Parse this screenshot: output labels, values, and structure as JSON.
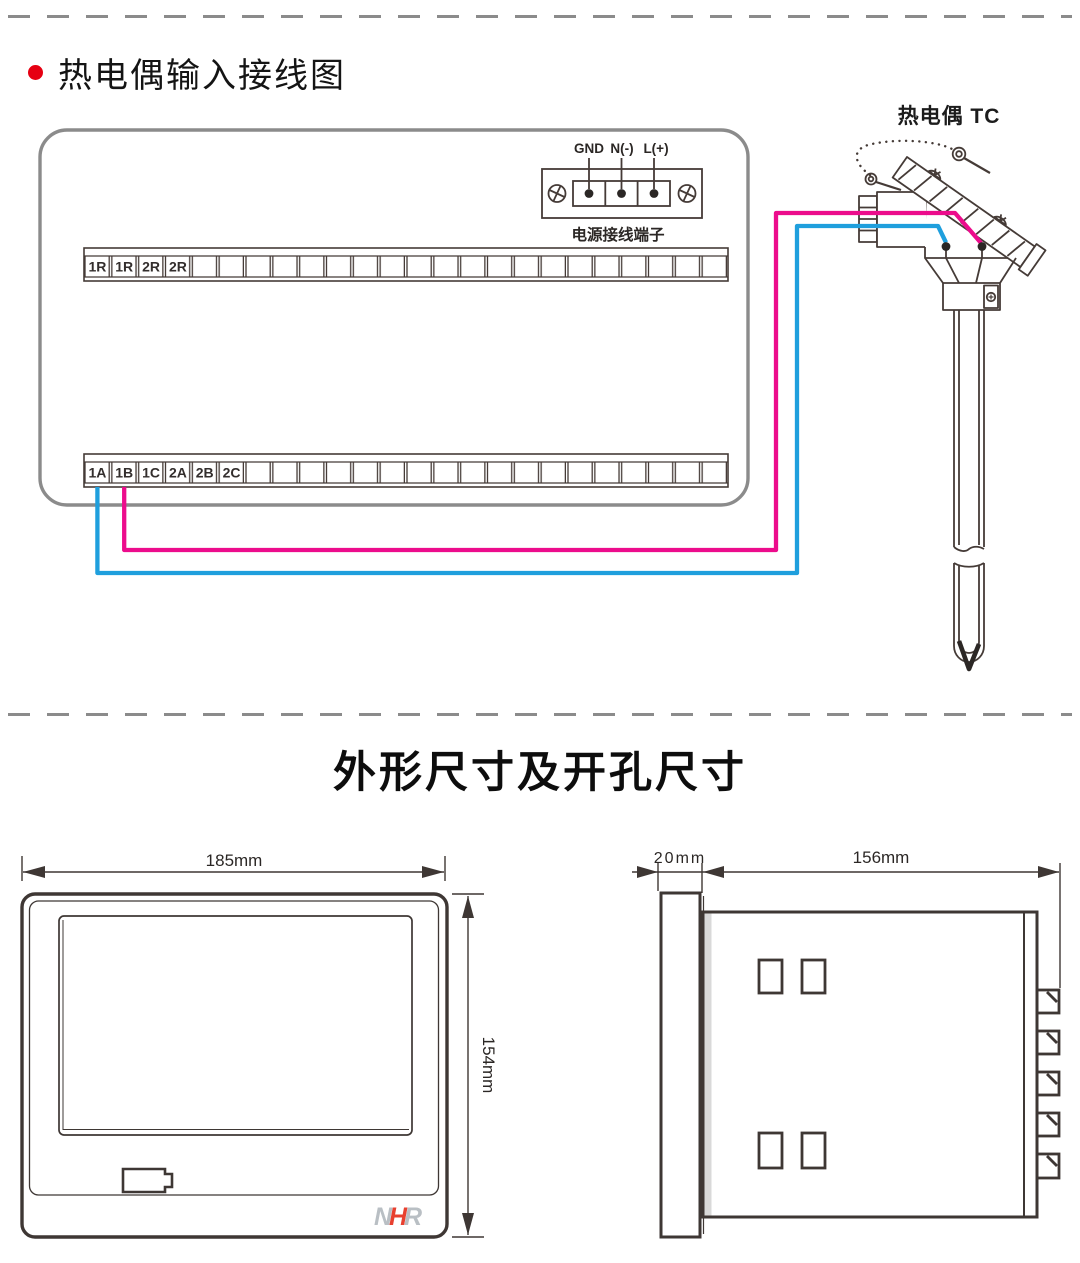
{
  "wiring": {
    "title": "热电偶输入接线图",
    "power_terminal": {
      "labels": [
        "GND",
        "N(-)",
        "L(+)"
      ],
      "caption": "电源接线端子"
    },
    "top_strip": {
      "labels": [
        "1R",
        "1R",
        "2R",
        "2R"
      ]
    },
    "bottom_strip": {
      "labels": [
        "1A",
        "1B",
        "1C",
        "2A",
        "2B",
        "2C"
      ]
    },
    "thermocouple": {
      "label": "热电偶 TC"
    },
    "wire_colors": {
      "positive": "#ec0c8c",
      "negative": "#1f9fdd"
    }
  },
  "dimensions": {
    "title": "外形尺寸及开孔尺寸",
    "front_view": {
      "width": "185mm",
      "height": "154mm",
      "logo": [
        "N",
        "H",
        "R"
      ]
    },
    "side_view": {
      "depth": "20mm",
      "body_length": "156mm"
    }
  },
  "colors": {
    "outline": "#453b37",
    "panel_border": "#8b8b8b",
    "bullet_red": "#e60012",
    "logo_gray": "#b9bfc4",
    "logo_red": "#e8402f"
  }
}
